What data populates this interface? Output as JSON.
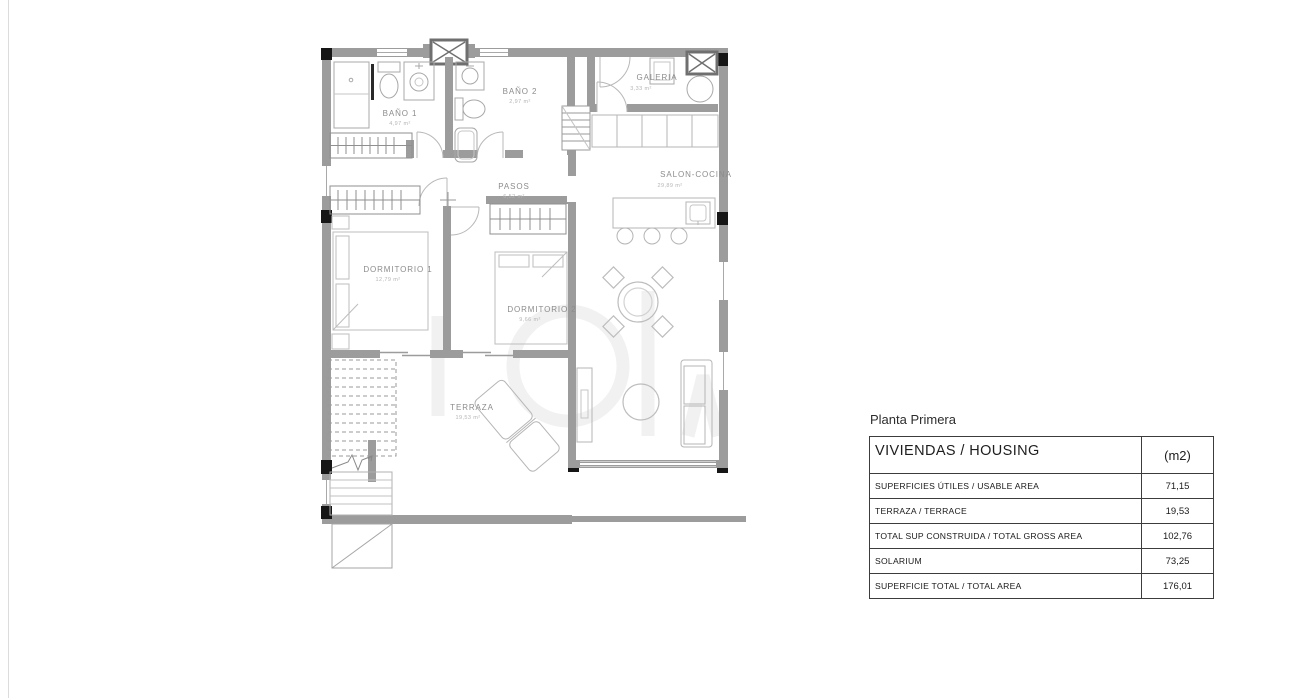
{
  "plan": {
    "rooms": [
      {
        "id": "bano1",
        "label": "BAÑO 1",
        "area": "4,97 m²"
      },
      {
        "id": "bano2",
        "label": "BAÑO 2",
        "area": "2,97 m²"
      },
      {
        "id": "galeria",
        "label": "GALERIA",
        "area": "3,33 m²"
      },
      {
        "id": "pasos",
        "label": "PASOS",
        "area": "6,52 m²"
      },
      {
        "id": "salon",
        "label": "SALON-COCINA",
        "area": "29,89 m²"
      },
      {
        "id": "dorm1",
        "label": "DORMITORIO 1",
        "area": "12,79 m²"
      },
      {
        "id": "dorm2",
        "label": "DORMITORIO 2",
        "area": "9,66 m²"
      },
      {
        "id": "terraza",
        "label": "TERRAZA",
        "area": "19,53 m²"
      }
    ],
    "colors": {
      "wall": "#9c9c9c",
      "column": "#161616",
      "furniture": "#bdbdbd",
      "label": "#8c8c8c"
    }
  },
  "table": {
    "title": "Planta Primera",
    "header": {
      "col1": "VIVIENDAS / HOUSING",
      "col2": "(m2)"
    },
    "rows": [
      {
        "label": "SUPERFICIES ÚTILES / USABLE AREA",
        "value": "71,15"
      },
      {
        "label": "TERRAZA / TERRACE",
        "value": "19,53"
      },
      {
        "label": "TOTAL SUP CONSTRUIDA / TOTAL GROSS AREA",
        "value": "102,76"
      },
      {
        "label": "SOLARIUM",
        "value": "73,25"
      },
      {
        "label": "SUPERFICIE TOTAL / TOTAL AREA",
        "value": "176,01"
      }
    ]
  }
}
